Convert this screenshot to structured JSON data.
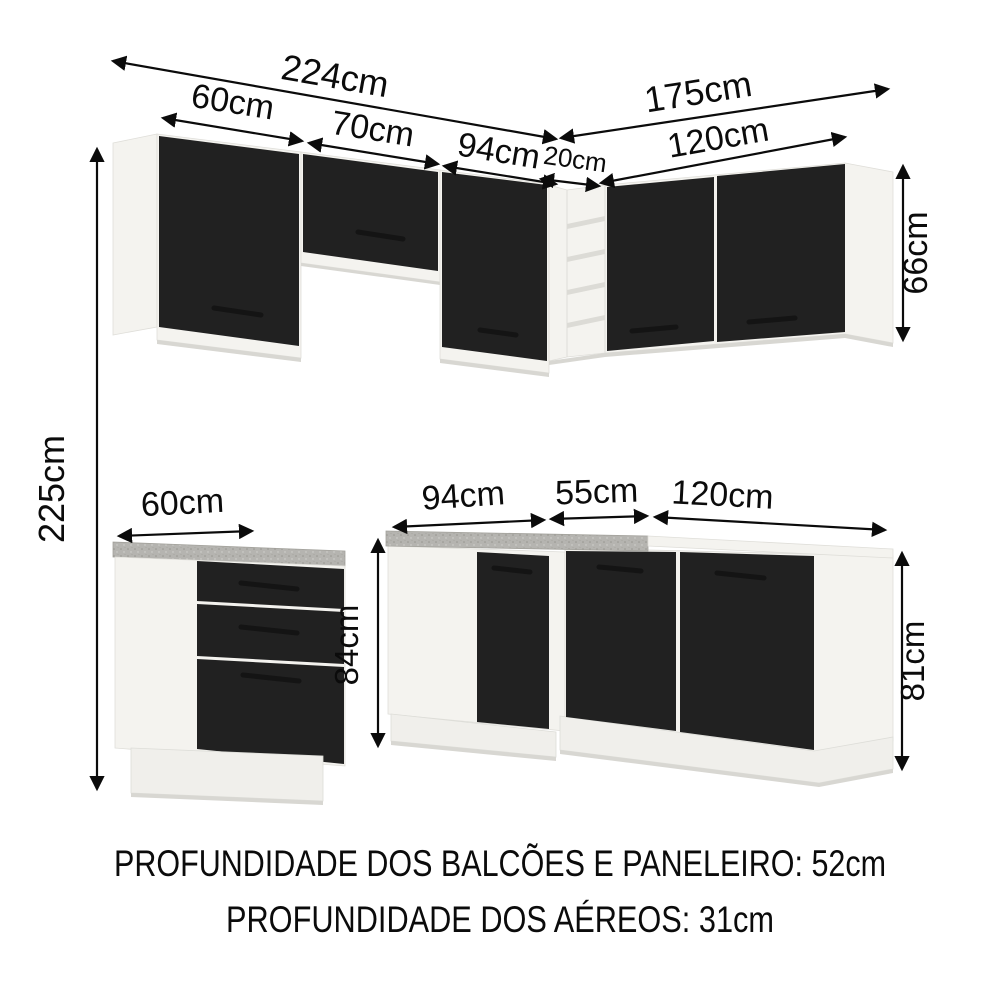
{
  "title": "Cozinha de canto - diagrama de dimensoes",
  "colors": {
    "background": "#ffffff",
    "door_black": "#212121",
    "carcass_white": "#f4f3ef",
    "countertop_gray": "#b5b4b0",
    "shadow_gray": "#d8d7d2",
    "text_black": "#0b0b0b"
  },
  "dims": {
    "upper_left_total": "224cm",
    "upper_left_seg_1": "60cm",
    "upper_left_seg_2": "70cm",
    "upper_left_seg_3": "94cm",
    "corner_shelf_width": "20cm",
    "upper_right_total": "175cm",
    "upper_right_seg": "120cm",
    "upper_height": "66cm",
    "overall_height": "225cm",
    "base_left_width": "60cm",
    "base_height": "84cm",
    "base_corner_left": "94cm",
    "base_corner_width": "55cm",
    "base_right_width": "120cm",
    "base_right_height": "81cm"
  },
  "footnotes": {
    "balcoes_paneleiro": "PROFUNDIDADE DOS BALCÕES E PANELEIRO: 52cm",
    "aereos": "PROFUNDIDADE DOS AÉREOS: 31cm"
  },
  "cabinets": {
    "upper_left_run": {
      "total_width": "224cm",
      "units": [
        {
          "width": "60cm",
          "style": "1 porta preta"
        },
        {
          "width": "70cm",
          "style": "1 porta preta sobre vao aberto"
        },
        {
          "width": "94cm",
          "style": "1 porta preta"
        }
      ]
    },
    "upper_right_run": {
      "total_width": "175cm",
      "height": "66cm",
      "units": [
        {
          "width": "20cm",
          "style": "nicho de canto aberto",
          "shelves": 4
        },
        {
          "width": "120cm",
          "style": "2 portas pretas"
        }
      ]
    },
    "base_left_unit": {
      "width": "60cm",
      "height": "84cm",
      "style": "3 gavetas pretas, tampo cinza"
    },
    "base_corner_unit": {
      "front_width": "94cm",
      "corner_width": "55cm",
      "style": "portas pretas, tampo cinza"
    },
    "base_right_unit": {
      "width": "120cm",
      "height": "81cm",
      "style": "portas pretas"
    },
    "overall_height": "225cm"
  }
}
